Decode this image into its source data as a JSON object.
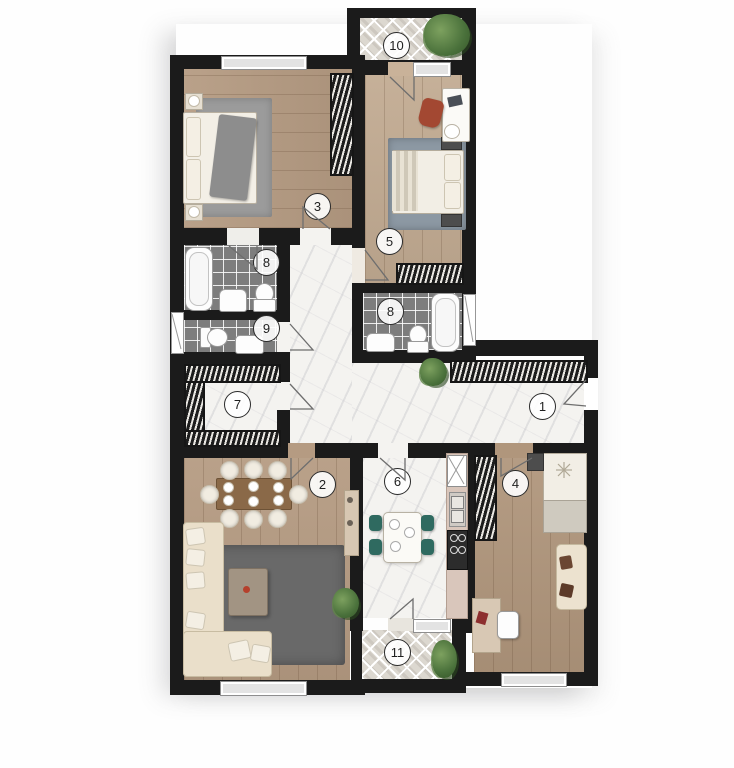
{
  "plan_type": "apartment-floor-plan",
  "labels": {
    "hall": "1",
    "living": "2",
    "bedroom_a": "3",
    "bedroom_c": "4",
    "bedroom_b": "5",
    "kitchen": "6",
    "closet": "7",
    "bathroom_a": "8",
    "bathroom_b": "8",
    "wc": "9",
    "balcony_top": "10",
    "balcony_bottom": "11"
  },
  "colors": {
    "wall": "#1b1b1b",
    "wood_floor": "#b59b82",
    "wood_floor_light": "#c2ab92",
    "marble_floor": "#f4f3f0",
    "bathroom_tile": "#7d7d7d",
    "balcony_tile": "#dcd8d0",
    "sofa_cream": "#eadfca",
    "living_rug": "#696969",
    "bedroom_rug_gray": "#9b9b9b",
    "bedroom_rug_blue": "#8c98a3",
    "kitchen_chair_teal": "#2f6a60",
    "accent_chair_red": "#a34832",
    "plant_green": "#4a713b",
    "window_gray": "#e3e3e3",
    "kitchen_counter": "#d9c6bb"
  }
}
